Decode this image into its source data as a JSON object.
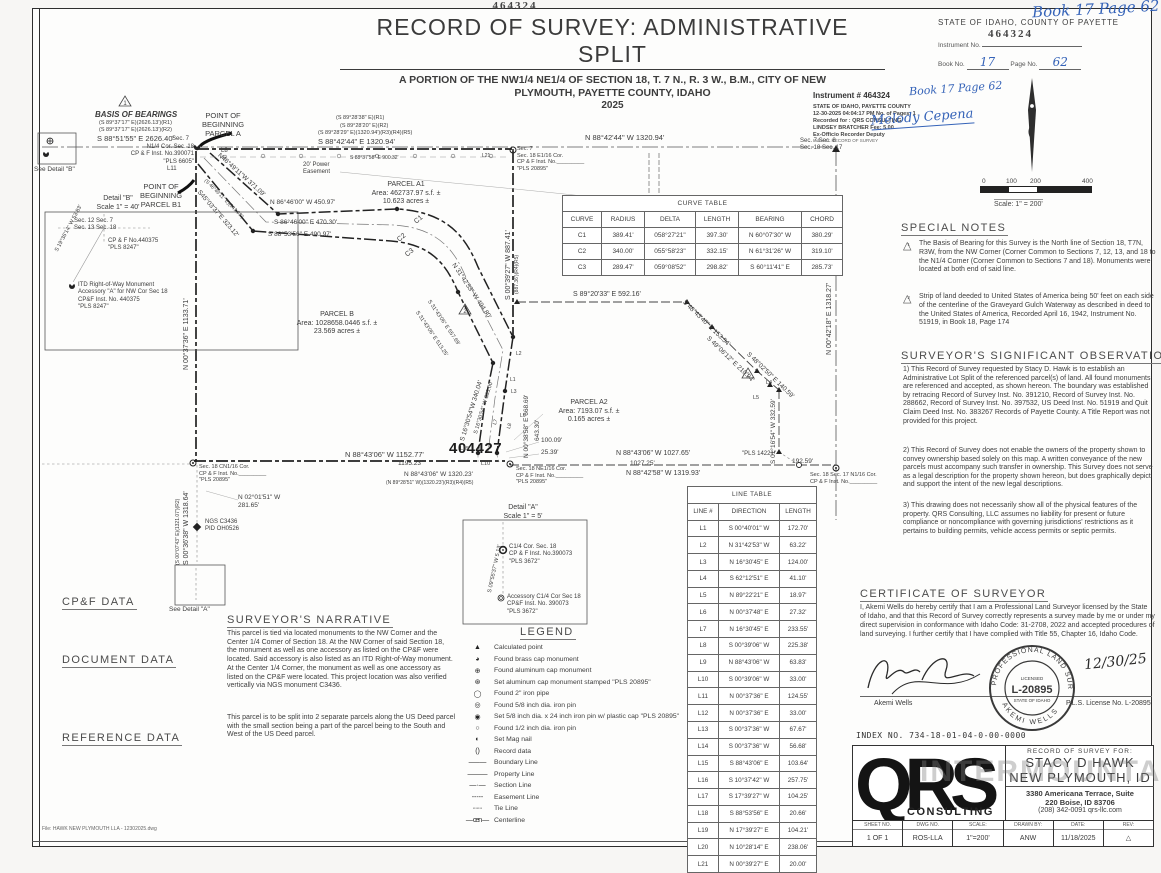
{
  "sheet": {
    "instrument_top": "464324"
  },
  "header": {
    "title": "RECORD  OF  SURVEY:  ADMINISTRATIVE  SPLIT",
    "subtitle1": "A PORTION OF THE NW1/4 NE1/4 OF SECTION 18, T. 7 N., R. 3 W., B.M., CITY OF NEW",
    "subtitle2": "PLYMOUTH, PAYETTE COUNTY, IDAHO",
    "year": "2025"
  },
  "county_block": {
    "handwritten": "Book 17 Page 62",
    "state_line": "STATE  OF  IDAHO,  COUNTY  OF  PAYETTE",
    "stamp": "464324",
    "instrument_label": "Instrument No.",
    "book_label": "Book No.",
    "book_value": "17",
    "page_label": "Page No.",
    "page_value": "62"
  },
  "recorder_stamp": {
    "line1": "Instrument #  464324",
    "hand1": "Book 17 Page 62",
    "line2": "STATE OF IDAHO, PAYETTE COUNTY",
    "line3": "12-30-2025      04:04:17 PM    No. of Pages: 1",
    "line4": "Recorded for : QRS CONSULTING",
    "line5": "LINDSEY BRATCHER                         Fee: 5.00",
    "line6": "Ex-Officio Recorder   Deputy",
    "hand2": "Melody Cepena",
    "line7": "Index to: RECORD OF SURVEY"
  },
  "north_scale": {
    "ticks": [
      "0",
      "100",
      "200",
      "400"
    ],
    "scale_label": "Scale:   1\" =  200'"
  },
  "curve_table": {
    "title": "CURVE TABLE",
    "headers": [
      "CURVE",
      "RADIUS",
      "DELTA",
      "LENGTH",
      "BEARING",
      "CHORD"
    ],
    "rows": [
      {
        "c": "C1",
        "r": "389.41'",
        "d": "058°27'21\"",
        "l": "397.30'",
        "b": "N 60°07'30\" W",
        "ch": "380.29'"
      },
      {
        "c": "C2",
        "r": "340.00'",
        "d": "055°58'23\"",
        "l": "332.15'",
        "b": "N 61°31'26\" W",
        "ch": "319.10'"
      },
      {
        "c": "C3",
        "r": "289.47'",
        "d": "059°08'52\"",
        "l": "298.82'",
        "b": "S 60°11'41\" E",
        "ch": "285.73'"
      }
    ]
  },
  "line_table": {
    "title": "LINE TABLE",
    "headers": [
      "LINE #",
      "DIRECTION",
      "LENGTH"
    ],
    "rows": [
      {
        "n": "L1",
        "dir": "S 00°40'01\" W",
        "len": "172.70'"
      },
      {
        "n": "L2",
        "dir": "N 31°42'53\" W",
        "len": "63.22'"
      },
      {
        "n": "L3",
        "dir": "N 16°30'45\" E",
        "len": "124.00'"
      },
      {
        "n": "L4",
        "dir": "S 62°12'51\" E",
        "len": "41.10'"
      },
      {
        "n": "L5",
        "dir": "N 89°22'21\" E",
        "len": "18.97'"
      },
      {
        "n": "L6",
        "dir": "N 00°37'48\" E",
        "len": "27.32'"
      },
      {
        "n": "L7",
        "dir": "N 16°30'45\" E",
        "len": "233.55'"
      },
      {
        "n": "L8",
        "dir": "S 00°39'06\" W",
        "len": "225.38'"
      },
      {
        "n": "L9",
        "dir": "N 88°43'06\" W",
        "len": "63.83'"
      },
      {
        "n": "L10",
        "dir": "S 00°39'06\" W",
        "len": "33.00'"
      },
      {
        "n": "L11",
        "dir": "N 00°37'36\" E",
        "len": "124.55'"
      },
      {
        "n": "L12",
        "dir": "N 00°37'36\" E",
        "len": "33.00'"
      },
      {
        "n": "L13",
        "dir": "S 00°37'36\" W",
        "len": "67.67'"
      },
      {
        "n": "L14",
        "dir": "S 00°37'36\" W",
        "len": "56.68'"
      },
      {
        "n": "L15",
        "dir": "S 88°43'06\" E",
        "len": "103.64'"
      },
      {
        "n": "L16",
        "dir": "S 10°37'42\" W",
        "len": "257.75'"
      },
      {
        "n": "L17",
        "dir": "S 17°39'27\" W",
        "len": "104.25'"
      },
      {
        "n": "L18",
        "dir": "S 88°53'56\" E",
        "len": "20.66'"
      },
      {
        "n": "L19",
        "dir": "N 17°39'27\" E",
        "len": "104.21'"
      },
      {
        "n": "L20",
        "dir": "N 10°28'14\" E",
        "len": "238.06'"
      },
      {
        "n": "L21",
        "dir": "N 00°39'27\" E",
        "len": "20.00'"
      }
    ]
  },
  "special_notes": {
    "heading": "SPECIAL NOTES",
    "num1": "1",
    "num2": "2",
    "note1": "The Basis of Bearing for this Survey is the North line of Section 18, T7N, R3W, from the NW Corner (Corner Common to Sections 7, 12, 13, and 18 to the N1/4 Corner (Corner Common to Sections 7 and 18).  Monuments were located at both end of said line.",
    "note2": "Strip of land deeded to United States of America being 50' feet on each side of the centerline of the Graveyard Gulch Waterway as described in deed to the United States of America, Recorded April 16, 1942, Instrument No. 51919, in Book 18, Page 174"
  },
  "observations": {
    "heading": "SURVEYOR'S SIGNIFICANT OBSERVATIONS",
    "p1": "1) This Record of Survey requested by Stacy D. Hawk is to establish an Administrative Lot Split of the referenced parcel(s) of land.  All found monuments are referenced and accepted, as shown hereon.  The boundary was established by retracing Record of Survey Inst. No. 391210, Record of Survey Inst. No. 288662, Record of Survey Inst. No. 397532, US Deed Inst. No. 51919 and Quit Claim Deed Inst. No. 383267 Records of Payette County.  A Title Report was not provided for this project.",
    "p2": "2) This Record of Survey does not enable the owners of the property shown to convey ownership based solely on this map. A written conveyance of the new parcels must accompany such transfer in ownership. This Survey does not serve as a legal description for the property shown hereon, but does graphically depict and support the intent of the new legal descriptions.",
    "p3": "3) This drawing does not necessarily show all of the physical features of the property.  QRS Consulting, LLC assumes no liability for present or future compliance or noncompliance with governing jurisdictions' restrictions as it pertains to building permits, vehicle access permits or septic permits."
  },
  "certificate": {
    "heading": "CERTIFICATE OF SURVEYOR",
    "body": "I, Akemi Wells do hereby certify that I am a Professional Land Surveyor licensed by  the State of Idaho, and that this Record of Survey correctly represents a survey made by me or under my direct supervision in conformance with Idaho Code: 31-2708, 2022 and accepted procedures of land surveying. I further certify that I have complied with Title 55, Chapter 16, Idaho Code.",
    "signature_name": "Akemi Wells",
    "seal_top": "PROFESSIONAL LAND SURVEYOR",
    "seal_licensed": "LICENSED",
    "seal_number": "L-20895",
    "seal_state": "STATE OF IDAHO",
    "seal_name": "AKEMI WELLS",
    "date_hand": "12/30/25",
    "license_line": "P.L.S. License No. L-20895"
  },
  "index_line": "INDEX  NO.    734-18-01-04-0-00-0000",
  "title_block": {
    "logo_text": "QRS",
    "logo_sub": "CONSULTING",
    "watermark": "INTERMOUNTAIN",
    "for_label": "RECORD  OF  SURVEY  FOR:",
    "client1": "STACY D HAWK",
    "client2": "NEW PLYMOUTH, ID",
    "addr1": "3380 Americana Terrace, Suite",
    "addr2": "220     Boise, ID 83706",
    "addr3": "(208) 342-0091      qrs-llc.com",
    "cols": [
      {
        "h": "SHEET NO.",
        "v": "1 OF 1"
      },
      {
        "h": "DWG NO.",
        "v": "ROS-LLA"
      },
      {
        "h": "SCALE:",
        "v": "1\"=200'"
      },
      {
        "h": "DRAWN BY:",
        "v": "ANW"
      },
      {
        "h": "DATE:",
        "v": "11/18/2025"
      },
      {
        "h": "REV:",
        "v": "△"
      }
    ]
  },
  "cpf_data": {
    "heading": "CP&F DATA",
    "items": [
      {
        "t": "C1)   J3 S1/4 Cor Sec 7, Inst. No. 390071"
      },
      {
        "t": "C2)   J25 SW Cor Sec 7, Inst. No. 440375"
      },
      {
        "t": "C3)   L3 C1/4 Cor Sec 18, Inst. No. 390073"
      },
      {
        "t": "C4)   L5 E1/4 Cor Sec 18, Inst. No. 438874"
      }
    ]
  },
  "document_data": {
    "heading": "DOCUMENT DATA",
    "items": [
      {
        "t": "D1)   NGS Monument C3436, PID OH0526"
      },
      {
        "t": "D2)   Alliance Title Property Profile 07N03W180800"
      },
      {
        "t": "D3)   Quit Claim Deed, Inst. No. 383763"
      },
      {
        "t": "D4)   Quit Claim Deed, Inst. No. 383267"
      },
      {
        "t": "D5)   Warranty Deed, Inst. No. 51919"
      }
    ]
  },
  "reference_data": {
    "heading": "REFERENCE DATA",
    "items": [
      {
        "t": "R1)   Record of Survey Inst. No. 391210"
      },
      {
        "t": "R2)   Record of Survey Inst. No. 288662"
      },
      {
        "t": "R3)   Record of Survey Inst. No. 397532"
      },
      {
        "t": "R4)   Record of Survey Inst. No. 404496"
      },
      {
        "t": "R5)   Record of Survey Inst. No. 389563"
      },
      {
        "t": "R6)   Record of Survey Inst. No. 325093"
      },
      {
        "t": "R7)   Record of Survey Inst. No. 256299"
      },
      {
        "t": "R8)   Record of Survey Inst. No. 27655"
      }
    ]
  },
  "file_note": "File:  HAWK NEW PLYMOUTH LLA - 12302025.dwg",
  "narrative": {
    "heading": "SURVEYOR'S NARRATIVE",
    "p1": "This parcel is tied via located monuments to the NW Corner and the Center 1/4 Corner of Section 18.  At the NW Corner of said Section 18, the monument as well as one accessory as listed on the CP&F were located.  Said accessory is also listed as an ITD Right-of-Way monument.  At the Center 1/4 Corner, the monument as well as one accessory as listed on the CP&F were located.  This project location was also verified vertically via NGS monument C3436.",
    "p2": "This parcel is to be split into 2 separate parcels along the US Deed parcel with the small section being a part of the parcel being to the South and West of the US Deed parcel."
  },
  "legend": {
    "heading": "LEGEND",
    "items": [
      {
        "glyph": "▲",
        "label": "Calculated point"
      },
      {
        "glyph": "◕",
        "label": "Found brass cap monument"
      },
      {
        "glyph": "⊕",
        "label": "Found aluminum cap monument"
      },
      {
        "glyph": "⊛",
        "label": "Set aluminum cap monument stamped \"PLS 20895\""
      },
      {
        "glyph": "◯",
        "label": "Found 2\" iron pipe"
      },
      {
        "glyph": "◎",
        "label": "Found 5/8 inch dia. iron pin"
      },
      {
        "glyph": "◉",
        "label": "Set 5/8 inch dia. x 24 inch iron pin w/ plastic cap \"PLS 20895\""
      },
      {
        "glyph": "○",
        "label": "Found 1/2 inch dia. iron pin"
      },
      {
        "glyph": "◐",
        "label": "Set Mag nail"
      },
      {
        "glyph": "(  )",
        "label": "Record data"
      },
      {
        "glyph": "— – —",
        "label": "Boundary Line"
      },
      {
        "glyph": "— ——",
        "label": "Property Line"
      },
      {
        "glyph": "— · —",
        "label": "Section Line"
      },
      {
        "glyph": "- - - - -",
        "label": "Easement Line"
      },
      {
        "glyph": "·······",
        "label": "Tie Line"
      },
      {
        "glyph": "— cen —",
        "label": "Centerline"
      }
    ]
  },
  "map": {
    "tri1": "1",
    "tri2": "2",
    "stamp": "404427",
    "basis_heading": "BASIS  OF  BEARINGS",
    "basis_r1": "(S 89°37'17\" E)(2626.13')(R1)",
    "basis_r2": "(S 89°37'17\" E)(2626.13')(R2)",
    "basis_meas": "S 88°51'55\" E   2626.40'",
    "n14_sec7": "Sec. 7",
    "n14_block": "N1/4 Cor. Sec. 18\nCP & F Inst. No.390071\n\"PLS 6605\"",
    "l11": "L11",
    "l8": "L8",
    "l21": "L21",
    "pob_a": "POINT OF\nBEGINNING\nPARCEL A",
    "pob_b1": "POINT OF\nBEGINNING\nPARCEL B1",
    "top_r1": "(S 89°28'38\" E)(R1)",
    "top_r2": "(S 89°28'20\" E)(R2)",
    "top_r345": "(S 89°28'29\" E)(1320.94')(R3)(R4)(R5)",
    "top_meas": "S 88°42'44\" E   1320.94'",
    "top_small": "S 88°37'58\" E   900.32'",
    "top_right_meas": "N 88°42'44\" W   1320.94'",
    "e116_block": "Sec. 7\nSec. 18 E1/16 Cor.\nCP & F Inst. No._________\n\"PLS 20895\"",
    "ne_corner": "Sec. 7     Sec. 8\nSec. 18    Sec. 17",
    "power_easement": "20' Power\nEasement",
    "parcel_a1": "PARCEL A1\nArea: 462737.97 s.f. ±\n10.623 acres ±",
    "parcel_b": "PARCEL B\nArea: 1028658.0446 s.f. ±\n23.569 acres ±",
    "parcel_a2": "PARCEL A2\nArea: 7193.07 s.f. ±\n0.165 acres ±",
    "diag_46": "N46°49'11\"W  371.09'",
    "diag_46r": "(S 46°49'11\" E)(343.98')",
    "diag_45": "S45°03'37\"E  323.12'",
    "h_8646": "N 86°46'00\" W   450.97'",
    "h_8646b": "S 86°46'00\" E   470.30'",
    "h_8853": "S 88°53'56\" E   490.97'",
    "c1": "C1",
    "c2": "C2",
    "c3": "C3",
    "v_0039": "S 00°39'27\" W   887.41'",
    "v_0039r": "(887.36')(R4)(R5)",
    "diag_31": "N 31°42'53\" W   494.80'",
    "diag_31r": "S 31°43'06\" E   557.69'",
    "diag_31b": "S 31°43'06\" E   513.25'",
    "v_0037": "N 00°37'36\" E   1133.71'",
    "s_1630": "S 16°30'54\"W  340.04'",
    "s_1630b": "S 16°30'54\" W  383.00'",
    "v_0038": "N 00°38'58\" E  668.69'",
    "v_0038b": "643.30'",
    "cn116_block": "Sec. 18 CN1/16 Cor.\nCP & F Inst. No._________\n\"PLS 20895\"",
    "bot_1152": "N 88°43'06\" W   1152.77'",
    "bot_1195": "1195.23'",
    "bot_1320": "N 88°43'06\" W  1320.23'",
    "bot_1320r": "(N 89°28'51\" W)(1320.23')(R3)(R4)(R5)",
    "ne116_block": "Sec. 18 NE1/16 Cor.\nCP & F Inst. No._________\n\"PLS 20895\"",
    "d_10009": "100.09'",
    "d_2539": "25.39'",
    "l10": "L10",
    "l15": "L15",
    "l1": "L1",
    "l2": "L2",
    "l3": "L3",
    "l6": "L6",
    "l7": "L7",
    "l8b": "L8",
    "l16": "L16",
    "l20": "L20",
    "l4": "L4",
    "l5": "L5",
    "s_8920": "S 89°20'33\" E   592.16'",
    "s_4843": "S 48°43'40\" E   153.54'",
    "s_4906": "S 49°06'12\" E   210.94'",
    "s_4802": "S 48°02'50\" E   140.59'",
    "v_0116": "S 01°16'54\" W   332.59'",
    "pls14221": "\"PLS 14221\"",
    "d_19259": "192.59'",
    "bot_1027": "N 88°43'06\" W   1027.65'",
    "bot_1027b": "1027.25'",
    "bot_1319": "N 88°42'58\" W   1319.93'",
    "v_0042": "N 00°42'18\" E   1318.27'",
    "n116_block": "Sec. 18    Sec. 17 N1/16 Cor.\nCP & F Inst. No._________",
    "v_0036": "S 00°36'38\" W   1318.64'",
    "v_0036r": "(S 00°07'43\" E)(1321.07')(R2)",
    "ngs_block": "NGS C3436\nPID OH0526",
    "n_0201": "N 02°01'51\" W\n281.65'",
    "see_detail_a": "See Detail \"A\"",
    "see_detail_b": "See Detail \"B\"",
    "detail_b_title": "Detail \"B\"\nScale 1\" = 40'",
    "db_secs": "Sec. 12    Sec. 7\nSec. 13    Sec. 18",
    "db_cpf": "CP & F No.440375\n\"PLS 8247\"",
    "db_bearing": "S 19°36'14\" W  53.83'",
    "db_itd": "ITD Right-of-Way Monument\nAccessory \"A\" for NW Cor Sec 18\nCP&F Inst. No. 440375\n\"PLS 8247\"",
    "detail_a_title": "Detail \"A\"\nScale 1\" = 5'",
    "da_c14": "C1/4 Cor. Sec. 18\nCP & F Inst. No.390073\n\"PLS 3672\"",
    "da_bearing": "S 09°55'37\" W  5.13'",
    "da_acc": "Accessory C1/4 Cor Sec 18\nCP&F Inst. No. 390073\n\"PLS 3672\""
  }
}
